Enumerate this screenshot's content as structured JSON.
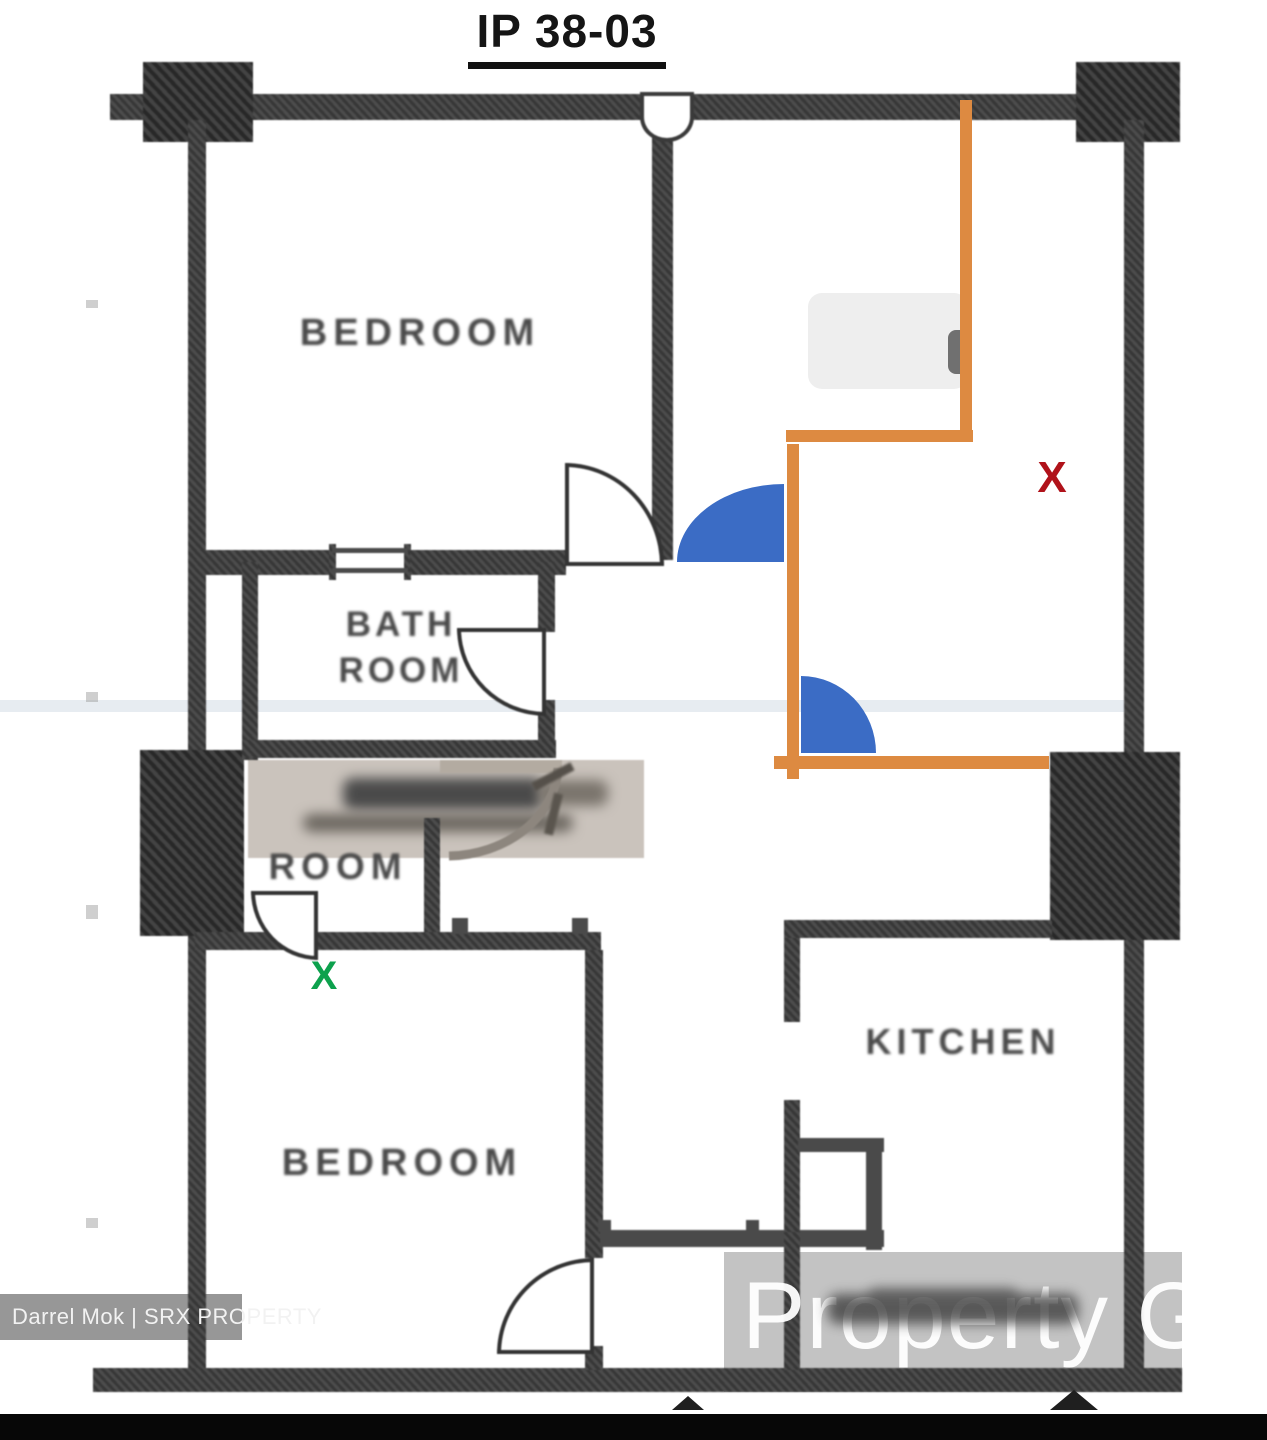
{
  "title": "IP 38-03",
  "rooms": {
    "bedroom_top": "BEDROOM",
    "bathroom_line1": "BATH",
    "bathroom_line2": "ROOM",
    "store_room": "ROOM",
    "bedroom_bottom": "BEDROOM",
    "kitchen": "KITCHEN"
  },
  "marks": {
    "red_x": "X",
    "green_x": "X"
  },
  "colors": {
    "annotation_orange": "#dd8a41",
    "annotation_blue": "#3b6cc5",
    "red_x_color": "#b0121a",
    "green_x_color": "#0da14d",
    "wall_color": "#3d3d3d"
  },
  "watermarks": {
    "bottom_left": "Darrel Mok | SRX PROPERTY",
    "bottom_right": "Property G"
  }
}
